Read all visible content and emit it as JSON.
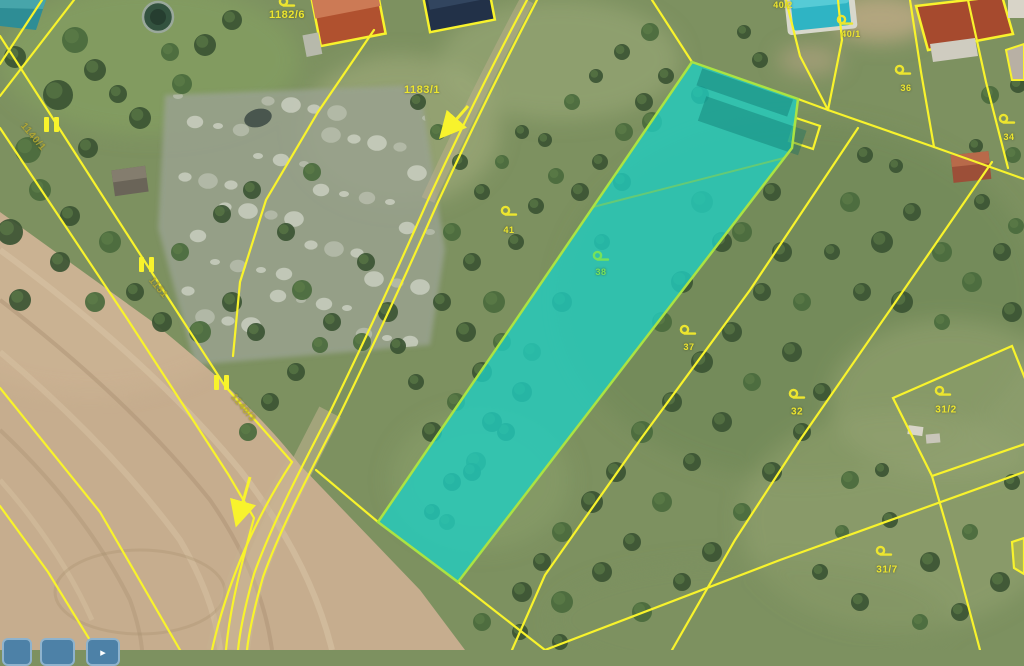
{
  "map": {
    "selected_parcel": {
      "number": "38",
      "land_use_symbol": "orchard"
    },
    "labels": [
      {
        "text": "1182/6",
        "x": 287,
        "y": 15,
        "size": 11,
        "color": "yellow",
        "rot": 0
      },
      {
        "text": "1183/1",
        "x": 422,
        "y": 90,
        "size": 11,
        "color": "yellow",
        "rot": 0
      },
      {
        "text": "40/2",
        "x": 783,
        "y": 5,
        "size": 9,
        "color": "yellow",
        "rot": 0
      },
      {
        "text": "40/1",
        "x": 851,
        "y": 34,
        "size": 9,
        "color": "yellow",
        "rot": 0
      },
      {
        "text": "36",
        "x": 906,
        "y": 88,
        "size": 9,
        "color": "yellow",
        "rot": 0
      },
      {
        "text": "34",
        "x": 1009,
        "y": 137,
        "size": 9,
        "color": "yellow",
        "rot": 0
      },
      {
        "text": "41",
        "x": 509,
        "y": 230,
        "size": 9,
        "color": "yellow",
        "rot": 0
      },
      {
        "text": "38",
        "x": 601,
        "y": 272,
        "size": 9,
        "color": "green",
        "rot": 0
      },
      {
        "text": "37",
        "x": 689,
        "y": 347,
        "size": 9,
        "color": "yellow",
        "rot": 0
      },
      {
        "text": "32",
        "x": 797,
        "y": 412,
        "size": 10,
        "color": "yellow",
        "rot": 0
      },
      {
        "text": "31/2",
        "x": 946,
        "y": 410,
        "size": 10,
        "color": "yellow",
        "rot": 0
      },
      {
        "text": "31/7",
        "x": 887,
        "y": 570,
        "size": 10,
        "color": "yellow",
        "rot": 0
      },
      {
        "text": "1140/1",
        "x": 33,
        "y": 137,
        "size": 10,
        "color": "dim",
        "rot": 50
      },
      {
        "text": "1151",
        "x": 158,
        "y": 288,
        "size": 10,
        "color": "dim",
        "rot": 50
      },
      {
        "text": "1140/3",
        "x": 243,
        "y": 408,
        "size": 10,
        "color": "dim",
        "rot": 50
      }
    ],
    "symbols": [
      {
        "type": "orchard",
        "x": 287,
        "y": 3,
        "color": "yellow"
      },
      {
        "type": "orchard",
        "x": 509,
        "y": 212,
        "color": "yellow"
      },
      {
        "type": "orchard",
        "x": 601,
        "y": 257,
        "color": "green"
      },
      {
        "type": "orchard",
        "x": 688,
        "y": 331,
        "color": "yellow"
      },
      {
        "type": "orchard",
        "x": 797,
        "y": 395,
        "color": "yellow"
      },
      {
        "type": "orchard",
        "x": 943,
        "y": 392,
        "color": "yellow"
      },
      {
        "type": "orchard",
        "x": 884,
        "y": 552,
        "color": "yellow"
      },
      {
        "type": "orchard",
        "x": 903,
        "y": 71,
        "color": "yellow"
      },
      {
        "type": "orchard",
        "x": 1007,
        "y": 120,
        "color": "yellow"
      },
      {
        "type": "orchard",
        "x": 845,
        "y": 21,
        "color": "yellow"
      }
    ],
    "boundary_markers": [
      {
        "x": 51,
        "y": 125
      },
      {
        "x": 146,
        "y": 265
      },
      {
        "x": 221,
        "y": 383
      }
    ],
    "direction_arrows": [
      {
        "x1": 468,
        "y1": 106,
        "x2": 447,
        "y2": 130
      },
      {
        "x1": 250,
        "y1": 477,
        "x2": 239,
        "y2": 516
      }
    ]
  },
  "colors": {
    "parcel_line": "#f8f32c",
    "selected_fill": "#20cdc0",
    "selected_border": "#aae343",
    "label_yellow": "#ece52f",
    "label_green": "#76e25b",
    "label_dim": "#b7a930",
    "button_fill": "#4d81a7",
    "button_border": "#8fb3cd"
  },
  "toolbar": {
    "buttons": [
      {
        "glyph": ""
      },
      {
        "glyph": ""
      },
      {
        "glyph": "▸"
      }
    ]
  }
}
